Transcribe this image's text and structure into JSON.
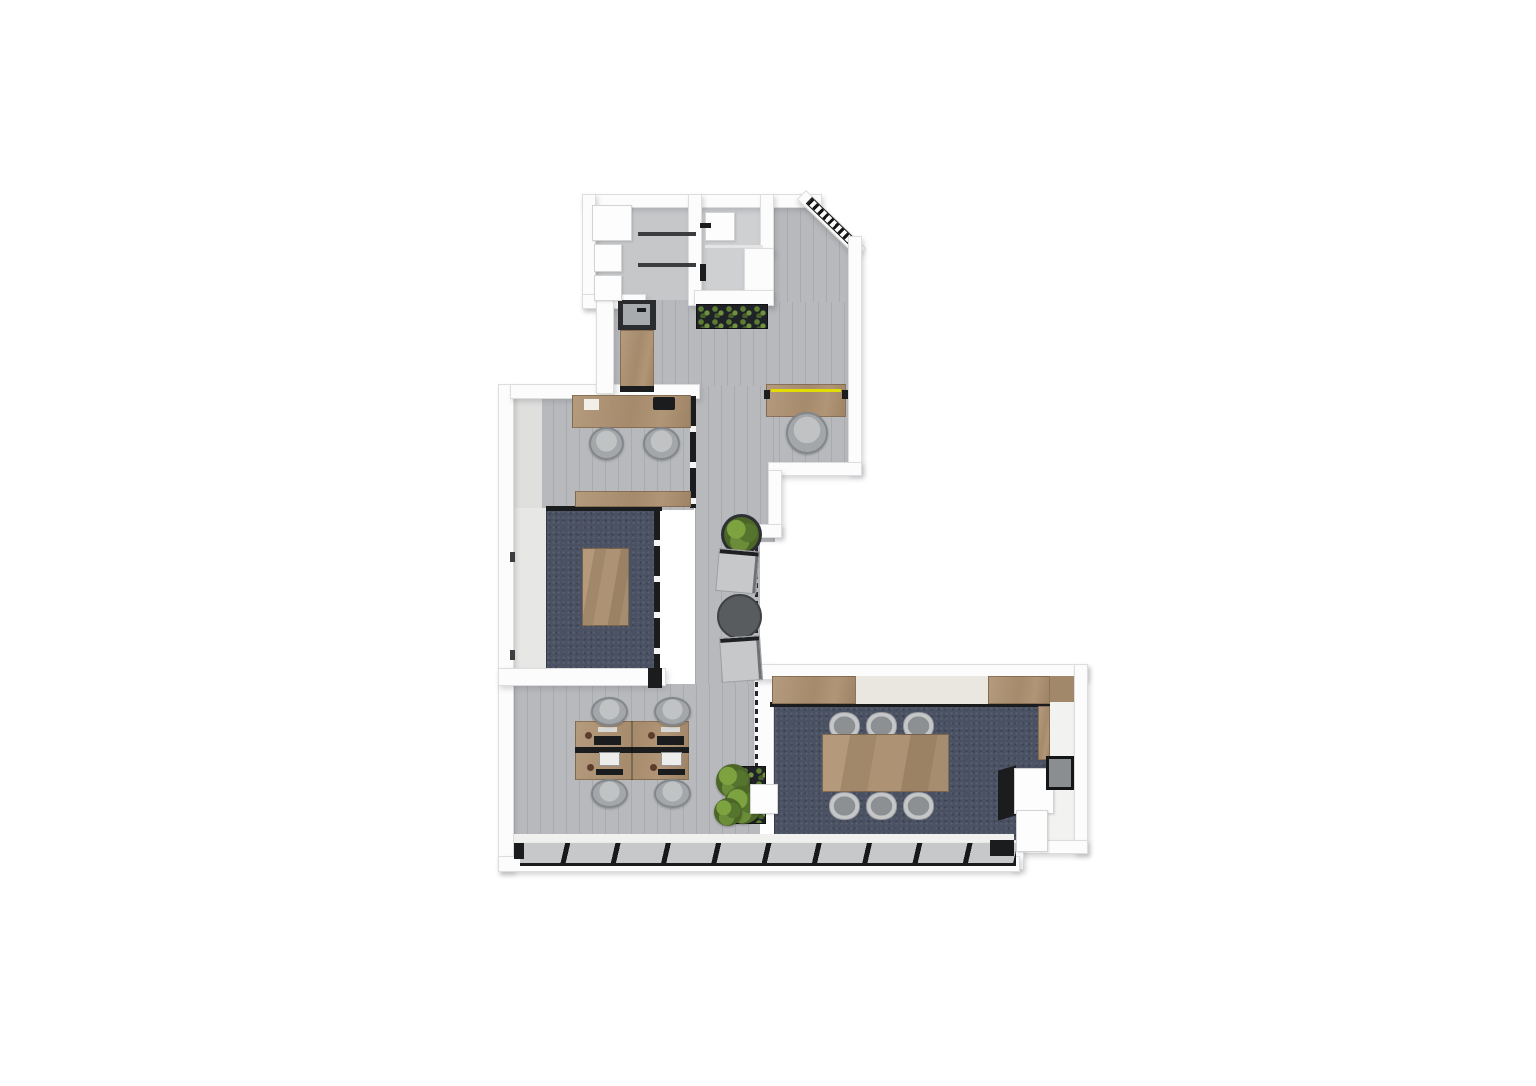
{
  "meta": {
    "title": "3d-office-floor-plan-render",
    "canvas": {
      "width": 1536,
      "height": 1086,
      "background": "#ffffff"
    }
  },
  "palette": {
    "wall_white": "#fcfcfc",
    "floor_gray_wood": "#b7b9bc",
    "carpet_navy": "#4a5163",
    "furniture_wood": "#a98f70",
    "accent_yellow": "#e3dc00",
    "plant_green": "#6b8d39",
    "frame_black": "#1b1c1e"
  },
  "elements": [
    {
      "n": "entry-hall-floor",
      "cls": "floor-wood",
      "x": 610,
      "y": 298,
      "w": 248,
      "h": 174
    },
    {
      "n": "entry-vestibule-floor",
      "cls": "floor-wood",
      "x": 774,
      "y": 200,
      "w": 78,
      "h": 102,
      "clip": "polygon(0% 0%, 46% 0%, 100% 42%, 100% 100%, 0% 100%)"
    },
    {
      "n": "corridor-floor",
      "cls": "floor-wood",
      "x": 695,
      "y": 386,
      "w": 80,
      "h": 156
    },
    {
      "n": "lounge-floor",
      "cls": "floor-wood",
      "x": 695,
      "y": 540,
      "w": 65,
      "h": 150
    },
    {
      "n": "office-room-floor",
      "cls": "floor-wood",
      "x": 514,
      "y": 398,
      "w": 180,
      "h": 112
    },
    {
      "n": "open-space-floor",
      "cls": "floor-wood",
      "x": 514,
      "y": 684,
      "w": 246,
      "h": 162
    },
    {
      "n": "meeting-room-sill",
      "cls": "rect",
      "x": 514,
      "y": 508,
      "w": 34,
      "h": 164,
      "bg": "#e7e7e5"
    },
    {
      "n": "office-wall-face",
      "cls": "rect",
      "x": 514,
      "y": 398,
      "w": 28,
      "h": 110,
      "bg": "#dfdfdd"
    },
    {
      "n": "utility-room-floor",
      "cls": "floor-plain",
      "x": 596,
      "y": 204,
      "w": 98,
      "h": 96,
      "bg": "#c6c7c9"
    },
    {
      "n": "bathroom-floor",
      "cls": "floor-plain",
      "x": 702,
      "y": 200,
      "w": 62,
      "h": 98,
      "bg": "#ced0d2"
    },
    {
      "n": "conference-side-floor",
      "cls": "rect",
      "x": 1044,
      "y": 678,
      "w": 34,
      "h": 166,
      "bg": "#f2f2f0"
    },
    {
      "n": "meeting-room-carpet",
      "cls": "carpet",
      "x": 546,
      "y": 510,
      "w": 112,
      "h": 162
    },
    {
      "n": "conference-carpet",
      "cls": "carpet",
      "x": 774,
      "y": 706,
      "w": 274,
      "h": 140
    },
    {
      "n": "wall-top",
      "cls": "wall",
      "x": 582,
      "y": 194,
      "w": 240,
      "h": 14
    },
    {
      "n": "wall-entry-diagonal",
      "cls": "wall",
      "x": 806,
      "y": 190,
      "w": 84,
      "h": 13,
      "rot": 44
    },
    {
      "n": "entry-door-hatch",
      "cls": "hatch",
      "x": 812,
      "y": 197,
      "w": 64,
      "h": 9,
      "rot": 44
    },
    {
      "n": "wall-right-upper",
      "cls": "wall",
      "x": 848,
      "y": 236,
      "w": 14,
      "h": 238
    },
    {
      "n": "wall-step-horizontal",
      "cls": "wall",
      "x": 768,
      "y": 462,
      "w": 94,
      "h": 14
    },
    {
      "n": "wall-mid-vertical",
      "cls": "wall",
      "x": 768,
      "y": 470,
      "w": 14,
      "h": 66
    },
    {
      "n": "wall-notch",
      "cls": "wall",
      "x": 750,
      "y": 524,
      "w": 32,
      "h": 14
    },
    {
      "n": "wall-left",
      "cls": "wall",
      "x": 498,
      "y": 384,
      "w": 16,
      "h": 488
    },
    {
      "n": "wall-office-top",
      "cls": "wall",
      "x": 510,
      "y": 384,
      "w": 190,
      "h": 15
    },
    {
      "n": "wall-utility-left",
      "cls": "wall",
      "x": 582,
      "y": 194,
      "w": 14,
      "h": 114
    },
    {
      "n": "wall-utility-bottom",
      "cls": "wall",
      "x": 582,
      "y": 294,
      "w": 64,
      "h": 15
    },
    {
      "n": "wall-step-vertical",
      "cls": "wall",
      "x": 596,
      "y": 298,
      "w": 18,
      "h": 96
    },
    {
      "n": "wall-utility-divider",
      "cls": "wall",
      "x": 688,
      "y": 194,
      "w": 14,
      "h": 112
    },
    {
      "n": "wall-bathroom-right",
      "cls": "wall",
      "x": 760,
      "y": 194,
      "w": 14,
      "h": 62
    },
    {
      "n": "wall-bathroom-step",
      "cls": "wall",
      "x": 744,
      "y": 248,
      "w": 30,
      "h": 58
    },
    {
      "n": "wall-bathroom-bottom",
      "cls": "wall",
      "x": 694,
      "y": 290,
      "w": 80,
      "h": 16
    },
    {
      "n": "wall-meeting-bottom",
      "cls": "wall",
      "x": 498,
      "y": 668,
      "w": 168,
      "h": 18
    },
    {
      "n": "wall-conference-left",
      "cls": "wall",
      "x": 754,
      "y": 664,
      "w": 20,
      "h": 134
    },
    {
      "n": "wall-conference-top",
      "cls": "wall",
      "x": 754,
      "y": 664,
      "w": 334,
      "h": 16
    },
    {
      "n": "wall-conference-right",
      "cls": "wall",
      "x": 1074,
      "y": 664,
      "w": 14,
      "h": 190
    },
    {
      "n": "wall-conference-bottomright",
      "cls": "wall",
      "x": 1016,
      "y": 840,
      "w": 72,
      "h": 14
    },
    {
      "n": "wall-conference-step",
      "cls": "wall",
      "x": 1010,
      "y": 840,
      "w": 14,
      "h": 30
    },
    {
      "n": "wall-bottom",
      "cls": "wall",
      "x": 498,
      "y": 856,
      "w": 522,
      "h": 16
    },
    {
      "n": "window-sill-strip",
      "cls": "rect",
      "x": 514,
      "y": 834,
      "w": 500,
      "h": 12,
      "bg": "#f0f0ee"
    },
    {
      "n": "window-band-south",
      "cls": "window-band",
      "x": 520,
      "y": 842,
      "w": 496,
      "h": 24
    },
    {
      "n": "window-corner-dark-right",
      "cls": "dark",
      "x": 990,
      "y": 840,
      "w": 24,
      "h": 16
    },
    {
      "n": "window-corner-dark-left",
      "cls": "dark",
      "x": 514,
      "y": 843,
      "w": 10,
      "h": 16
    },
    {
      "n": "office-glass-wall",
      "cls": "glass-v",
      "x": 690,
      "y": 396,
      "w": 6,
      "h": 112
    },
    {
      "n": "meeting-glass-wall",
      "cls": "glass-v",
      "x": 654,
      "y": 510,
      "w": 6,
      "h": 162
    },
    {
      "n": "meeting-divider-frame",
      "cls": "dark",
      "x": 546,
      "y": 506,
      "w": 116,
      "h": 5
    },
    {
      "n": "meeting-corner-glass",
      "cls": "dark",
      "x": 648,
      "y": 668,
      "w": 14,
      "h": 20
    },
    {
      "n": "lounge-glass-dashed",
      "cls": "dash-v",
      "x": 755,
      "y": 538,
      "w": 3,
      "h": 252
    },
    {
      "n": "conference-partition-frame",
      "cls": "dark",
      "x": 770,
      "y": 702,
      "w": 280,
      "h": 5
    },
    {
      "n": "kitchen-sink-counter",
      "cls": "rect",
      "x": 618,
      "y": 300,
      "w": 38,
      "h": 30,
      "bg": "#2a2c2e"
    },
    {
      "n": "kitchen-sink-basin",
      "cls": "rect",
      "x": 623,
      "y": 304,
      "w": 27,
      "h": 21,
      "bg": "#a8abad"
    },
    {
      "n": "kitchen-faucet",
      "cls": "dark",
      "x": 637,
      "y": 308,
      "w": 9,
      "h": 4
    },
    {
      "n": "kitchen-cabinet",
      "cls": "wood",
      "x": 620,
      "y": 330,
      "w": 34,
      "h": 58
    },
    {
      "n": "kitchen-cabinet-end",
      "cls": "dark",
      "x": 620,
      "y": 386,
      "w": 34,
      "h": 6
    },
    {
      "n": "entry-planter-box",
      "cls": "planter",
      "x": 696,
      "y": 304,
      "w": 72,
      "h": 25
    },
    {
      "n": "reception-desk",
      "cls": "wood",
      "x": 766,
      "y": 384,
      "w": 80,
      "h": 33
    },
    {
      "n": "reception-desk-accent-stripe",
      "cls": "rect",
      "x": 771,
      "y": 389,
      "w": 70,
      "h": 3,
      "bg": "#e3dc00"
    },
    {
      "n": "reception-desk-cap-left",
      "cls": "dark",
      "x": 764,
      "y": 390,
      "w": 6,
      "h": 9
    },
    {
      "n": "reception-desk-cap-right",
      "cls": "dark",
      "x": 842,
      "y": 390,
      "w": 6,
      "h": 9
    },
    {
      "n": "reception-chair",
      "cls": "chair",
      "x": 786,
      "y": 412,
      "w": 42,
      "h": 42
    },
    {
      "n": "office-desk",
      "cls": "wood",
      "x": 572,
      "y": 395,
      "w": 119,
      "h": 33
    },
    {
      "n": "office-desk-paper",
      "cls": "rect",
      "x": 584,
      "y": 399,
      "w": 15,
      "h": 11,
      "bg": "#f2efe9"
    },
    {
      "n": "office-desk-laptop",
      "cls": "dark",
      "x": 653,
      "y": 397,
      "w": 22,
      "h": 13,
      "r": 2
    },
    {
      "n": "office-chair-1",
      "cls": "chair",
      "x": 589,
      "y": 427,
      "w": 35,
      "h": 33
    },
    {
      "n": "office-chair-2",
      "cls": "chair",
      "x": 643,
      "y": 427,
      "w": 37,
      "h": 33
    },
    {
      "n": "office-credenza",
      "cls": "wood",
      "x": 575,
      "y": 491,
      "w": 116,
      "h": 16
    },
    {
      "n": "meeting-table",
      "cls": "wood-grain",
      "x": 582,
      "y": 548,
      "w": 47,
      "h": 78
    },
    {
      "n": "lounge-plant-pot",
      "cls": "circle",
      "x": 721,
      "y": 514,
      "w": 41,
      "h": 41,
      "bg": "#2e3135"
    },
    {
      "n": "lounge-plant",
      "cls": "plant",
      "x": 724,
      "y": 517,
      "w": 35,
      "h": 35
    },
    {
      "n": "lounge-armchair-1",
      "cls": "lounge-chair",
      "x": 719,
      "y": 548,
      "w": 41,
      "h": 43,
      "rot": 5
    },
    {
      "n": "lounge-coffee-table",
      "cls": "circle",
      "x": 717,
      "y": 594,
      "w": 45,
      "h": 45,
      "bg": "#595c5f",
      "bd": "2px solid #3f4144"
    },
    {
      "n": "lounge-armchair-2",
      "cls": "lounge-chair",
      "x": 719,
      "y": 638,
      "w": 41,
      "h": 45,
      "rot": -4
    },
    {
      "n": "workstation-desk-block",
      "cls": "wood",
      "x": 575,
      "y": 721,
      "w": 114,
      "h": 59
    },
    {
      "n": "workstation-spine",
      "cls": "dark",
      "x": 575,
      "y": 747,
      "w": 114,
      "h": 6
    },
    {
      "n": "workstation-divider",
      "cls": "rect",
      "x": 631,
      "y": 721,
      "w": 2,
      "h": 59,
      "bg": "rgba(0,0,0,.25)"
    },
    {
      "n": "workstation-monitor-tl",
      "cls": "dark",
      "x": 594,
      "y": 736,
      "w": 27,
      "h": 9
    },
    {
      "n": "workstation-monitor-tr",
      "cls": "dark",
      "x": 657,
      "y": 736,
      "w": 27,
      "h": 9
    },
    {
      "n": "workstation-keyboard-tl",
      "cls": "rect",
      "x": 598,
      "y": 727,
      "w": 19,
      "h": 5,
      "bg": "#d8d8d6"
    },
    {
      "n": "workstation-keyboard-tr",
      "cls": "rect",
      "x": 661,
      "y": 727,
      "w": 19,
      "h": 5,
      "bg": "#d8d8d6"
    },
    {
      "n": "workstation-monitor-bl",
      "cls": "screen",
      "x": 599,
      "y": 752,
      "w": 21,
      "h": 14
    },
    {
      "n": "workstation-monitor-br",
      "cls": "screen",
      "x": 661,
      "y": 752,
      "w": 21,
      "h": 14
    },
    {
      "n": "workstation-keyboard-bl",
      "cls": "dark",
      "x": 596,
      "y": 769,
      "w": 27,
      "h": 6
    },
    {
      "n": "workstation-keyboard-br",
      "cls": "dark",
      "x": 658,
      "y": 769,
      "w": 27,
      "h": 6
    },
    {
      "n": "workstation-accent-1",
      "cls": "circle",
      "x": 585,
      "y": 732,
      "w": 7,
      "h": 7,
      "bg": "#5d3c2a"
    },
    {
      "n": "workstation-accent-2",
      "cls": "circle",
      "x": 648,
      "y": 732,
      "w": 7,
      "h": 7,
      "bg": "#5d3c2a"
    },
    {
      "n": "workstation-accent-3",
      "cls": "circle",
      "x": 587,
      "y": 764,
      "w": 7,
      "h": 7,
      "bg": "#5d3c2a"
    },
    {
      "n": "workstation-accent-4",
      "cls": "circle",
      "x": 650,
      "y": 764,
      "w": 7,
      "h": 7,
      "bg": "#5d3c2a"
    },
    {
      "n": "workstation-chair-1",
      "cls": "chair",
      "x": 591,
      "y": 697,
      "w": 37,
      "h": 29
    },
    {
      "n": "workstation-chair-2",
      "cls": "chair",
      "x": 654,
      "y": 697,
      "w": 37,
      "h": 29
    },
    {
      "n": "workstation-chair-3",
      "cls": "chair",
      "x": 591,
      "y": 779,
      "w": 37,
      "h": 29
    },
    {
      "n": "workstation-chair-4",
      "cls": "chair",
      "x": 654,
      "y": 779,
      "w": 37,
      "h": 29
    },
    {
      "n": "open-space-planter",
      "cls": "planter",
      "x": 726,
      "y": 766,
      "w": 40,
      "h": 58
    },
    {
      "n": "open-space-plant-1",
      "cls": "plant",
      "x": 716,
      "y": 764,
      "w": 34,
      "h": 34
    },
    {
      "n": "open-space-plant-2",
      "cls": "plant",
      "x": 724,
      "y": 786,
      "w": 38,
      "h": 38
    },
    {
      "n": "open-space-plant-3",
      "cls": "plant",
      "x": 714,
      "y": 798,
      "w": 28,
      "h": 28
    },
    {
      "n": "structural-column",
      "cls": "white-box",
      "x": 750,
      "y": 784,
      "w": 28,
      "h": 30
    },
    {
      "n": "conference-wood-panel-1",
      "cls": "wood",
      "x": 772,
      "y": 676,
      "w": 84,
      "h": 28
    },
    {
      "n": "conference-cream-panel",
      "cls": "rect",
      "x": 856,
      "y": 676,
      "w": 132,
      "h": 28,
      "bg": "#eae7e0"
    },
    {
      "n": "conference-wood-panel-2",
      "cls": "wood",
      "x": 988,
      "y": 676,
      "w": 62,
      "h": 28
    },
    {
      "n": "conference-wood-panel-3",
      "cls": "rect",
      "x": 1050,
      "y": 676,
      "w": 24,
      "h": 26,
      "bg": "#a2886a"
    },
    {
      "n": "conference-sideboard",
      "cls": "wood",
      "x": 1038,
      "y": 706,
      "w": 12,
      "h": 54
    },
    {
      "n": "conference-chair-1",
      "cls": "chair-pill",
      "x": 829,
      "y": 712,
      "w": 31,
      "h": 28
    },
    {
      "n": "conference-chair-2",
      "cls": "chair-pill",
      "x": 866,
      "y": 712,
      "w": 31,
      "h": 28
    },
    {
      "n": "conference-chair-3",
      "cls": "chair-pill",
      "x": 903,
      "y": 712,
      "w": 31,
      "h": 28
    },
    {
      "n": "conference-chair-4",
      "cls": "chair-pill",
      "x": 829,
      "y": 792,
      "w": 31,
      "h": 28
    },
    {
      "n": "conference-chair-5",
      "cls": "chair-pill",
      "x": 866,
      "y": 792,
      "w": 31,
      "h": 28
    },
    {
      "n": "conference-chair-6",
      "cls": "chair-pill",
      "x": 903,
      "y": 792,
      "w": 31,
      "h": 28
    },
    {
      "n": "conference-table",
      "cls": "wood-grain",
      "x": 822,
      "y": 734,
      "w": 127,
      "h": 58
    },
    {
      "n": "conference-counter-front",
      "cls": "dark",
      "x": 998,
      "y": 768,
      "w": 18,
      "h": 50,
      "tf": "skewY(-16deg)"
    },
    {
      "n": "conference-counter-top",
      "cls": "white-box",
      "x": 1014,
      "y": 768,
      "w": 40,
      "h": 46
    },
    {
      "n": "conference-counter-return",
      "cls": "white-box",
      "x": 1016,
      "y": 810,
      "w": 32,
      "h": 42
    },
    {
      "n": "conference-glass-cabinet",
      "cls": "glass-box",
      "x": 1046,
      "y": 756,
      "w": 28,
      "h": 34
    },
    {
      "n": "closet-shelf-1",
      "cls": "white-box",
      "x": 592,
      "y": 205,
      "w": 40,
      "h": 36
    },
    {
      "n": "closet-shelf-2",
      "cls": "white-box",
      "x": 594,
      "y": 244,
      "w": 28,
      "h": 28
    },
    {
      "n": "closet-shelf-3",
      "cls": "white-box",
      "x": 594,
      "y": 275,
      "w": 28,
      "h": 26
    },
    {
      "n": "utility-counter-line-1",
      "cls": "dark-soft",
      "x": 638,
      "y": 232,
      "w": 58,
      "h": 4
    },
    {
      "n": "utility-counter-line-2",
      "cls": "dark-soft",
      "x": 638,
      "y": 263,
      "w": 58,
      "h": 4
    },
    {
      "n": "bathroom-fixture",
      "cls": "white-box",
      "x": 705,
      "y": 212,
      "w": 30,
      "h": 29
    },
    {
      "n": "bathroom-shelf-line",
      "cls": "rect",
      "x": 705,
      "y": 245,
      "w": 58,
      "h": 3,
      "bg": "#e4e4e4"
    },
    {
      "n": "bathroom-door-mark-1",
      "cls": "dark",
      "x": 700,
      "y": 223,
      "w": 11,
      "h": 5
    },
    {
      "n": "bathroom-door-mark-2",
      "cls": "dark",
      "x": 700,
      "y": 264,
      "w": 6,
      "h": 17
    },
    {
      "n": "left-wall-frame-tick-1",
      "cls": "dark-soft",
      "x": 510,
      "y": 552,
      "w": 5,
      "h": 10
    },
    {
      "n": "left-wall-frame-tick-2",
      "cls": "dark-soft",
      "x": 510,
      "y": 650,
      "w": 5,
      "h": 10
    }
  ]
}
